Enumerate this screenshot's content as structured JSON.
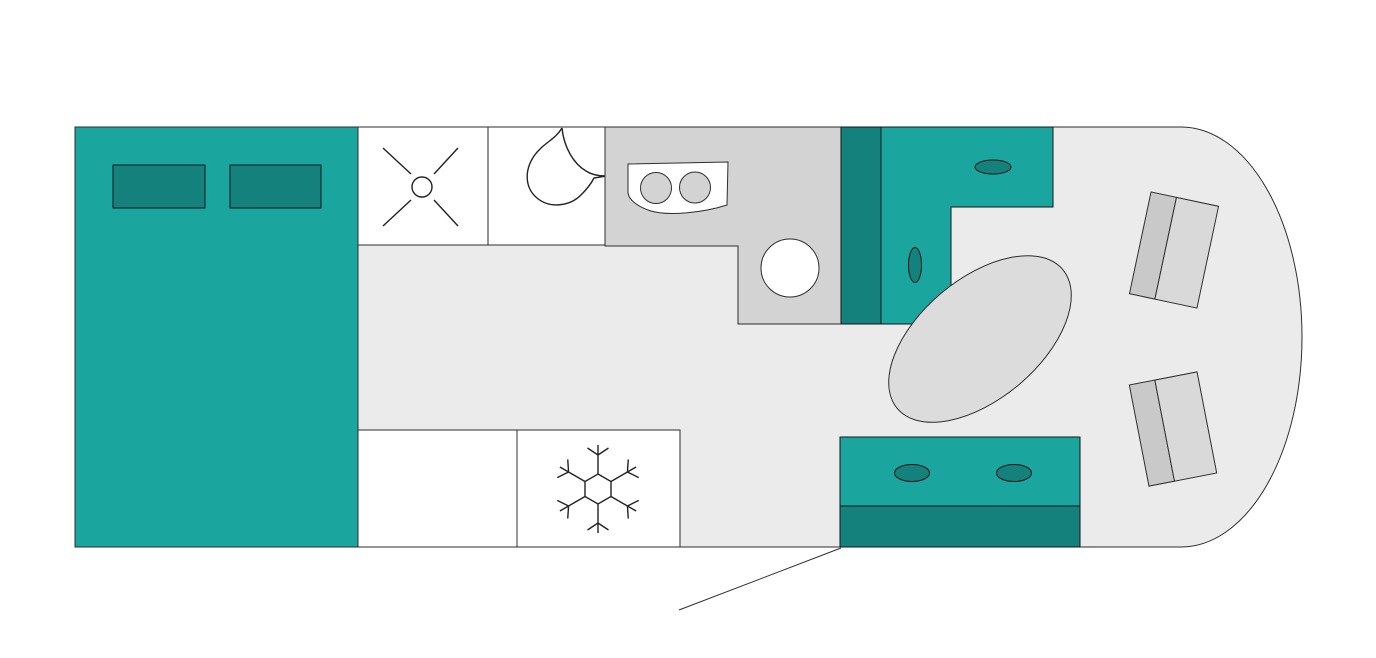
{
  "meta": {
    "title": "Motorhome floor plan",
    "view": "top-down schematic",
    "text_labels": []
  },
  "colors": {
    "page_background": "#ffffff",
    "floor": "#ebebeb",
    "furniture_teal": "#1aa69e",
    "furniture_teal_dark": "#14817c",
    "counter_gray": "#d3d3d3",
    "fixture_white": "#ffffff",
    "table_gray": "#dcdcdc",
    "seat_cushion_gray": "#d9d9d9",
    "seat_backrest_gray": "#c9c9c9",
    "outline": "#2e2e2e"
  },
  "components": {
    "bed": {
      "name": "double-bed",
      "pillow_count": 2
    },
    "shower": {
      "name": "shower-cubicle",
      "icon": "shower-drain-x"
    },
    "toilet": {
      "name": "toilet-room",
      "icon": "toilet-top-view"
    },
    "kitchen": {
      "name": "kitchen-counter",
      "burner_count": 2,
      "sink_count": 1
    },
    "tall_cabinet": {
      "name": "tall-cabinet"
    },
    "sideboard": {
      "name": "sideboard-unit",
      "knob_count": 2
    },
    "table": {
      "name": "dining-table",
      "shape": "oval"
    },
    "cab_seats": {
      "name": "cab-swivel-seats",
      "count": 2
    },
    "sofa_bench": {
      "name": "sofa-bench",
      "button_count": 2
    },
    "wardrobe": {
      "name": "wardrobe-cabinet"
    },
    "fridge": {
      "name": "fridge-freezer",
      "icon": "snowflake"
    },
    "entry": {
      "name": "entry-door-swing-line"
    }
  }
}
